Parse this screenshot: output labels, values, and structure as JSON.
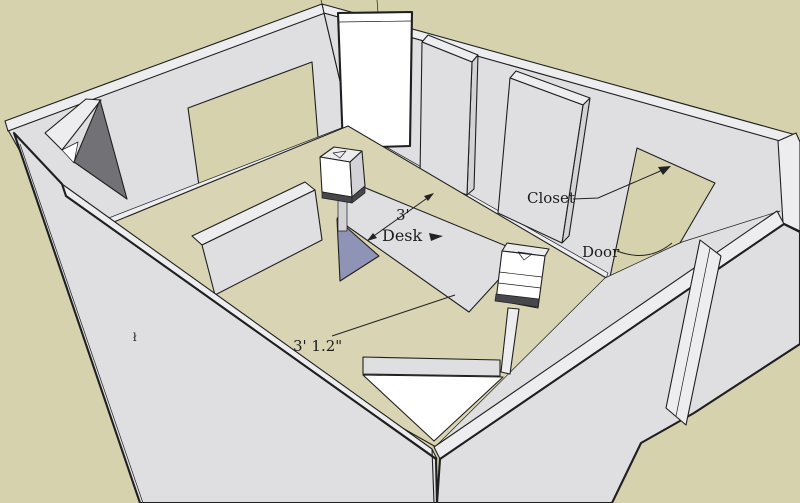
{
  "annotations": {
    "desk_label": "Desk",
    "desk_width_dimension": "3'",
    "closet_label": "Closet",
    "door_label": "Door",
    "floor_dimension": "3' 1.2\"",
    "wall_mark": "ł"
  },
  "colors": {
    "bg_tan": "#d6d2ae",
    "floor_tan": "#d9d5b4",
    "wall": "#dfdfe2",
    "wall_shade": "#d2d2d7",
    "light": "#ededf0",
    "white": "#ffffff",
    "dark": "#727276",
    "purple": "#8f93b6",
    "speaker_dark": "#47474b",
    "edge": "#1f1f1f"
  }
}
